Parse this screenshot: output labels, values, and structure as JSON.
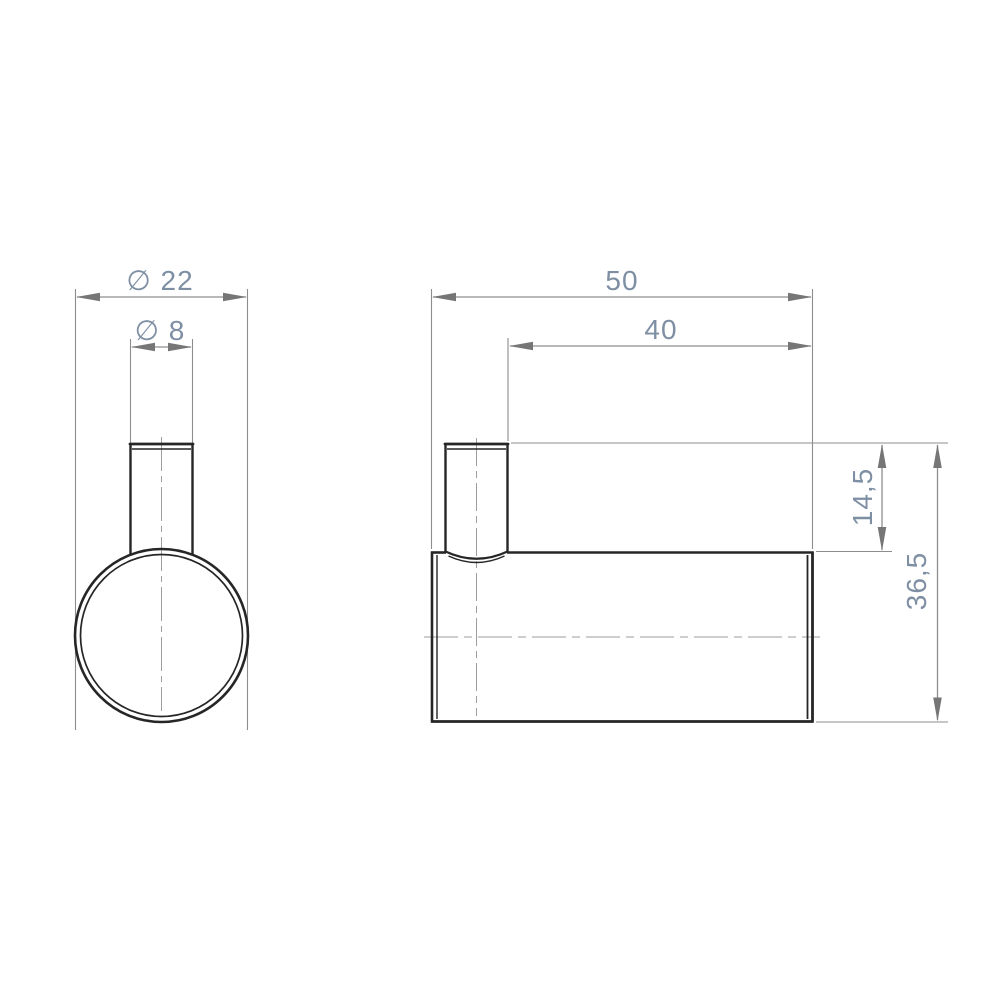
{
  "colors": {
    "background": "#ffffff",
    "outline": "#262626",
    "thin_line": "#8d8d8d",
    "arrow": "#767676",
    "centerline": "#9e9e9e",
    "dimension_text": "#7e8fa4"
  },
  "views": {
    "front": {
      "dimensions": {
        "body_diameter": {
          "label": "∅ 22",
          "value": 22
        },
        "peg_diameter": {
          "label": "∅ 8",
          "value": 8
        }
      }
    },
    "side": {
      "dimensions": {
        "overall_length": {
          "label": "50",
          "value": 50
        },
        "length_to_peg": {
          "label": "40",
          "value": 40
        },
        "peg_height": {
          "label": "14,5",
          "value": 14.5
        },
        "overall_height": {
          "label": "36,5",
          "value": 36.5
        }
      }
    }
  }
}
